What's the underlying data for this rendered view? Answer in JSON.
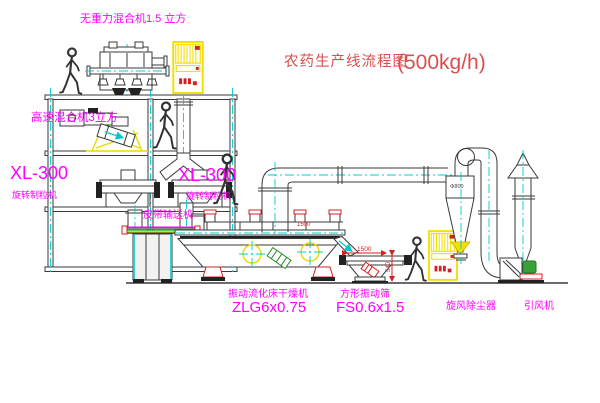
{
  "title": {
    "name": "农药生产线流程图",
    "capacity": "(500kg/h)"
  },
  "equipment_labels": {
    "gravity_mixer": "无重力混合机1.5 立方",
    "high_speed_mixer": "高速混合机3立方",
    "granulator_left_model": "XL-300",
    "granulator_left_name": "旋转制粒机",
    "granulator_right_model": "XL-300",
    "granulator_right_name": "旋转制粒机",
    "belt_conveyor": "皮带输送机",
    "dryer_name": "振动流化床干燥机",
    "dryer_model": "ZLG6x0.75",
    "screen_name": "方形振动筛",
    "screen_model": "FS0.6x1.5",
    "cyclone": "旋风除尘器",
    "fan": "引风机"
  },
  "dimensions": {
    "dryer_length": "1500",
    "screen_length": "1500",
    "screen_height": "540",
    "cyclone_diameter": "Φ800"
  },
  "colors": {
    "line": "#3a3a3a",
    "centerline": "#00cccc",
    "label_magenta": "#ff00ff",
    "title_red": "#d94f4f",
    "cabinet_yellow": "#f2e000",
    "accent_red": "#d42020",
    "motor_green": "#3aa03a"
  }
}
